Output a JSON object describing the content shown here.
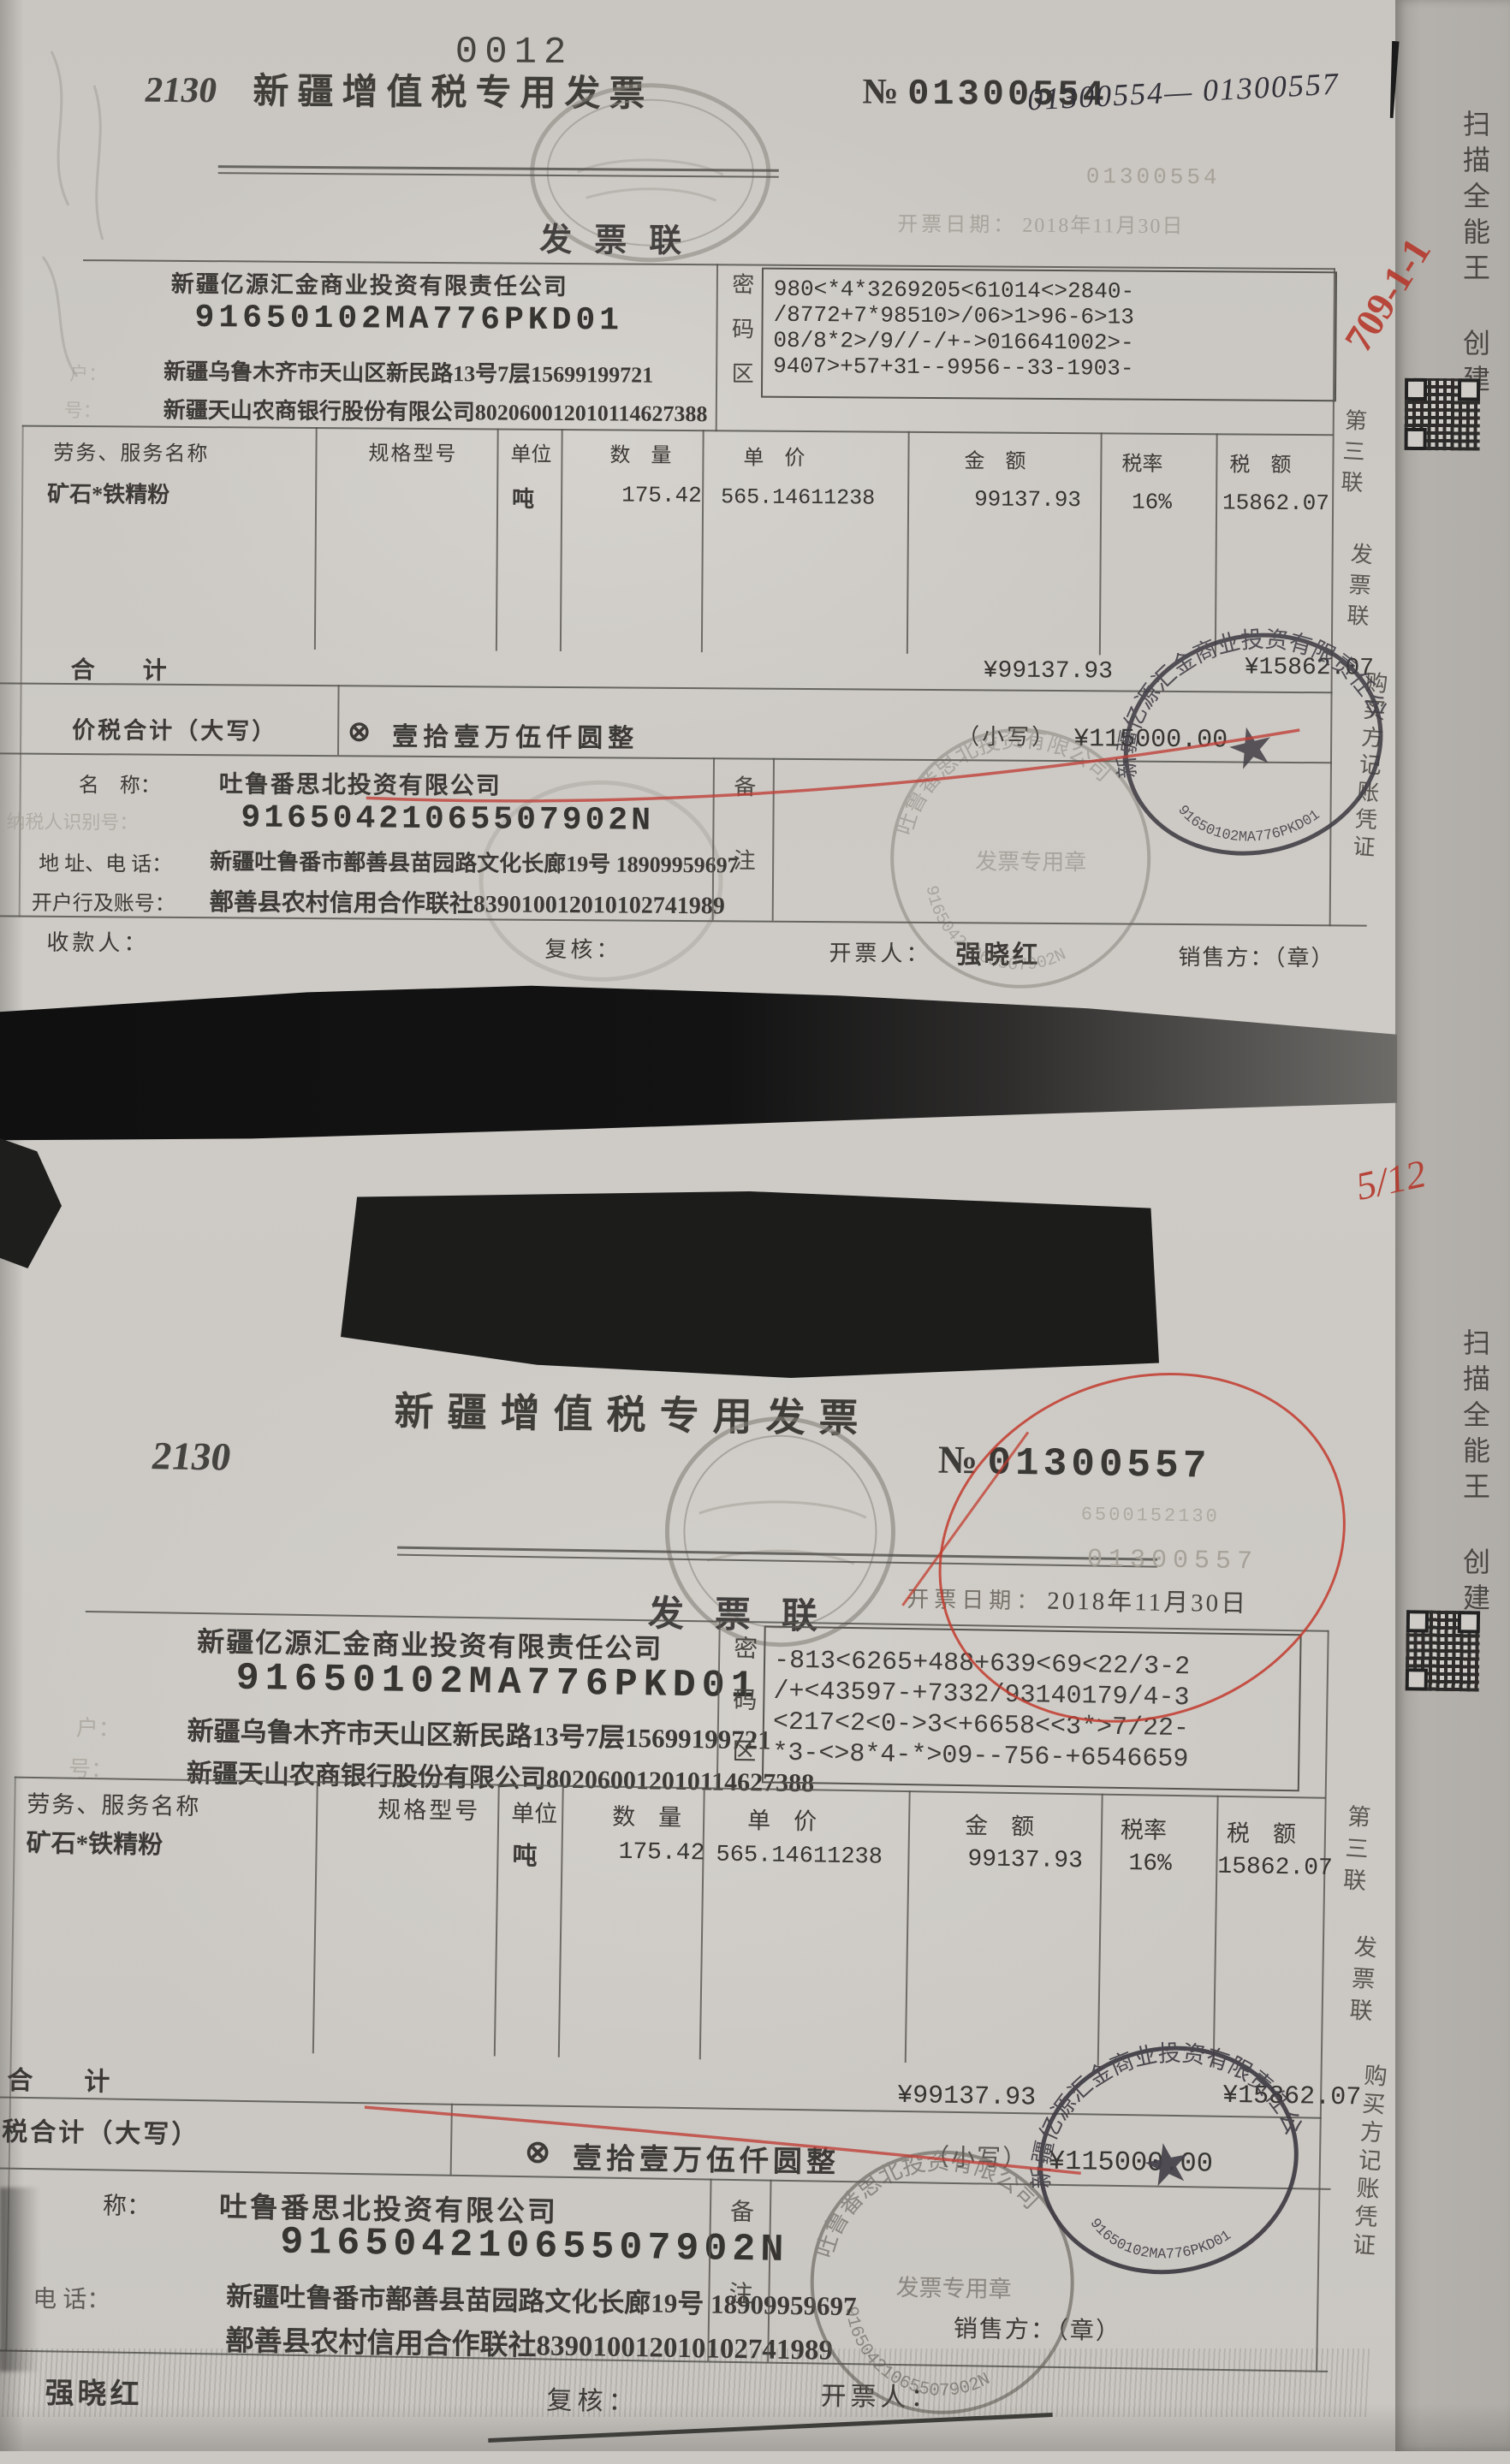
{
  "page": {
    "number": "0012",
    "scanner_watermark": "扫描全能王 创建"
  },
  "annotations": {
    "handwritten_serial_range": "01300554— 01300557",
    "red_mark_top": "709-1-1",
    "red_mark_middle": "5/12"
  },
  "labels": {
    "title": "新疆增值税专用发票",
    "copy": "发票联",
    "no_prefix": "№",
    "date_label": "开票日期：",
    "password_col": "密码区",
    "col_name": "劳务、服务名称",
    "col_spec": "规格型号",
    "col_unit": "单位",
    "col_qty": "数　量",
    "col_price": "单　价",
    "col_amount": "金　额",
    "col_taxrate": "税率",
    "col_tax": "税　额",
    "total_label": "合　　计",
    "grand_total_label": "价税合计（大写）",
    "cross_symbol": "⊗",
    "small_label": "（小写）",
    "remark_col": "备注",
    "margin_copy_1": "第三联",
    "margin_copy_2": "发票联",
    "margin_copy_3": "购买方记账凭证",
    "payee": "收款人：",
    "reviewer": "复核：",
    "drawer": "开票人：",
    "seller_chop": "销售方：（章）",
    "seller_name_label": "名　称：",
    "seller_taxid_label": "纳税人识别号：",
    "seller_addr_label": "地 址、电 话：",
    "seller_bank_label": "开户行及账号：",
    "frag_label_a": "户：",
    "frag_label_b": "号：",
    "frag_label_c": "称：",
    "frag_label_d": "电 话："
  },
  "stamps": {
    "oval_company": "新疆亿源汇金商业投资有限责任公司",
    "oval_number": "91650102MA776PKD01",
    "oval_type": "发票专用章",
    "round_company": "吐鲁番思北投资有限公司",
    "round_number": "91650421065507902N",
    "round_type": "发票专用章",
    "star": "★"
  },
  "invoice1": {
    "form_code": "2130",
    "number": "01300554",
    "number_ghost": "01300554",
    "date": "2018年11月30日",
    "buyer": {
      "name": "新疆亿源汇金商业投资有限责任公司",
      "tax_id": "91650102MA776PKD01",
      "address_phone": "新疆乌鲁木齐市天山区新民路13号7层15699199721",
      "bank_account": "新疆天山农商银行股份有限公司802060012010114627388"
    },
    "password_lines": [
      "980<*4*3269205<61014<>2840-",
      "/8772+7*98510>/06>1>96-6>13",
      "08/8*2>/9//-/+->016641002>-",
      "9407>+57+31--9956--33-1903-"
    ],
    "item": {
      "name": "矿石*铁精粉",
      "unit": "吨",
      "quantity": "175.42",
      "unit_price": "565.14611238",
      "amount": "99137.93",
      "tax_rate": "16%",
      "tax": "15862.07"
    },
    "total_amount": "¥99137.93",
    "total_tax": "¥15862.07",
    "amount_in_words": "壹拾壹万伍仟圆整",
    "amount_figures": "¥115000.00",
    "seller": {
      "name": "吐鲁番思北投资有限公司",
      "tax_id": "91650421065507902N",
      "address_phone": "新疆吐鲁番市鄯善县苗园路文化长廊19号 18909959697",
      "bank_account": "鄯善县农村信用合作联社839010012010102741989"
    },
    "drawer_name": "强晓红"
  },
  "invoice2": {
    "form_code": "2130",
    "number": "01300557",
    "number_ghost": "01300557",
    "code_ghost": "6500152130",
    "date": "2018年11月30日",
    "buyer": {
      "name": "新疆亿源汇金商业投资有限责任公司",
      "tax_id": "91650102MA776PKD01",
      "address_phone": "新疆乌鲁木齐市天山区新民路13号7层15699199721",
      "bank_account": "新疆天山农商银行股份有限公司802060012010114627388"
    },
    "password_lines": [
      "-813<6265+488+639<69<22/3-2",
      "/+<43597-+7332/93140179/4-3",
      "<217<2<0->3<+6658<<3*>7/22-",
      "*3-<>8*4-*>09--756-+6546659"
    ],
    "item": {
      "name": "矿石*铁精粉",
      "unit": "吨",
      "quantity": "175.42",
      "unit_price": "565.14611238",
      "amount": "99137.93",
      "tax_rate": "16%",
      "tax": "15862.07"
    },
    "total_amount": "¥99137.93",
    "total_tax": "¥15862.07",
    "amount_in_words": "壹拾壹万伍仟圆整",
    "amount_figures": "¥115000.00",
    "seller": {
      "name": "吐鲁番思北投资有限公司",
      "tax_id": "91650421065507902N",
      "address_phone": "新疆吐鲁番市鄯善县苗园路文化长廊19号 18909959697",
      "bank_account": "鄯善县农村信用合作联社839010012010102741989"
    },
    "drawer_name": "强晓红"
  }
}
